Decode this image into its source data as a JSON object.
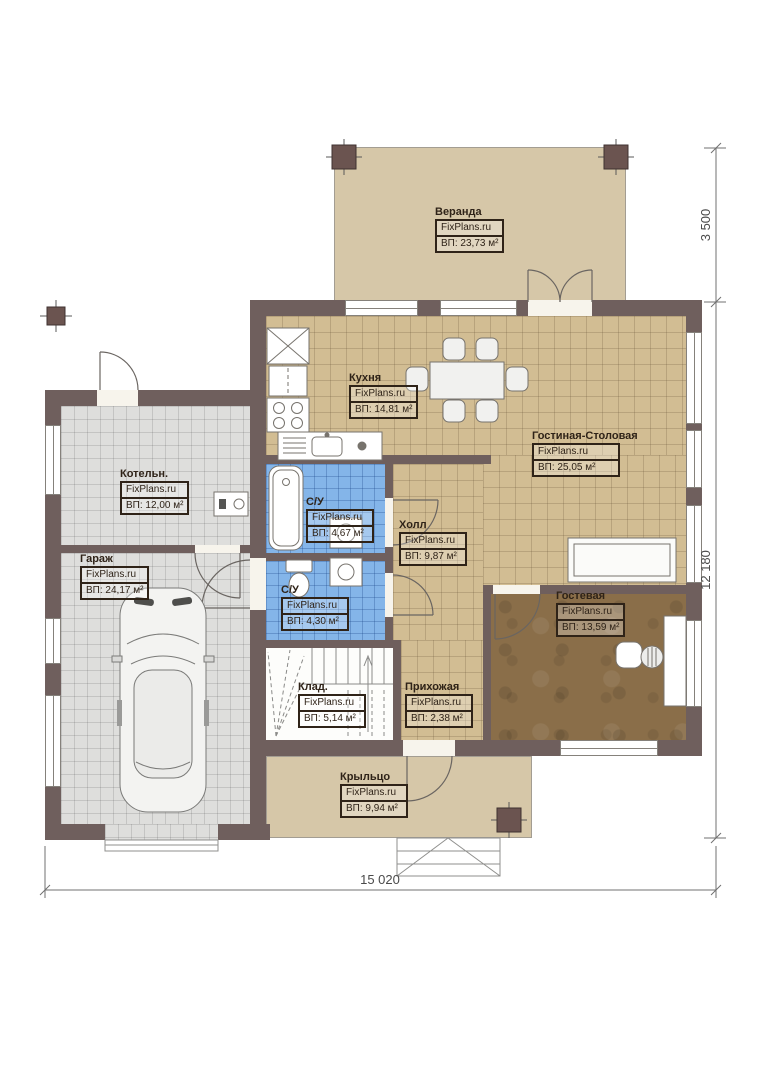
{
  "plan": {
    "rooms": [
      {
        "name": "Веранда",
        "watermark": "FixPlans.ru",
        "area": "ВП: 23,73 м²"
      },
      {
        "name": "Кухня",
        "watermark": "FixPlans.ru",
        "area": "ВП: 14,81 м²"
      },
      {
        "name": "Гостиная-Столовая",
        "watermark": "FixPlans.ru",
        "area": "ВП:   25,05 м²"
      },
      {
        "name": "Котельн.",
        "watermark": "FixPlans.ru",
        "area": "ВП: 12,00 м²"
      },
      {
        "name": "Гараж",
        "watermark": "FixPlans.ru",
        "area": "ВП: 24,17 м²"
      },
      {
        "name": "С/У",
        "watermark": "FixPlans.ru",
        "area": "ВП: 4,67 м²"
      },
      {
        "name": "Холл",
        "watermark": "FixPlans.ru",
        "area": "ВП: 9,87 м²"
      },
      {
        "name": "С/У",
        "watermark": "FixPlans.ru",
        "area": "ВП: 4,30 м²"
      },
      {
        "name": "Гостевая",
        "watermark": "FixPlans.ru",
        "area": "ВП: 13,59 м²"
      },
      {
        "name": "Клад.",
        "watermark": "FixPlans.ru",
        "area": "ВП: 5,14 м²"
      },
      {
        "name": "Прихожая",
        "watermark": "FixPlans.ru",
        "area": "ВП: 2,38 м²"
      },
      {
        "name": "Крыльцо",
        "watermark": "FixPlans.ru",
        "area": "ВП: 9,94 м²"
      }
    ],
    "dimensions": {
      "veranda_depth": "3 500",
      "house_depth": "12 180",
      "house_width": "15 020"
    },
    "colors": {
      "wall": "#6f5f5d",
      "tile_beige": "#d2bd93",
      "tile_blue": "#84b5e9",
      "tile_grey": "#dededc",
      "wood_brown": "#8a6e49",
      "deck_beige": "#d6c7a8"
    }
  }
}
